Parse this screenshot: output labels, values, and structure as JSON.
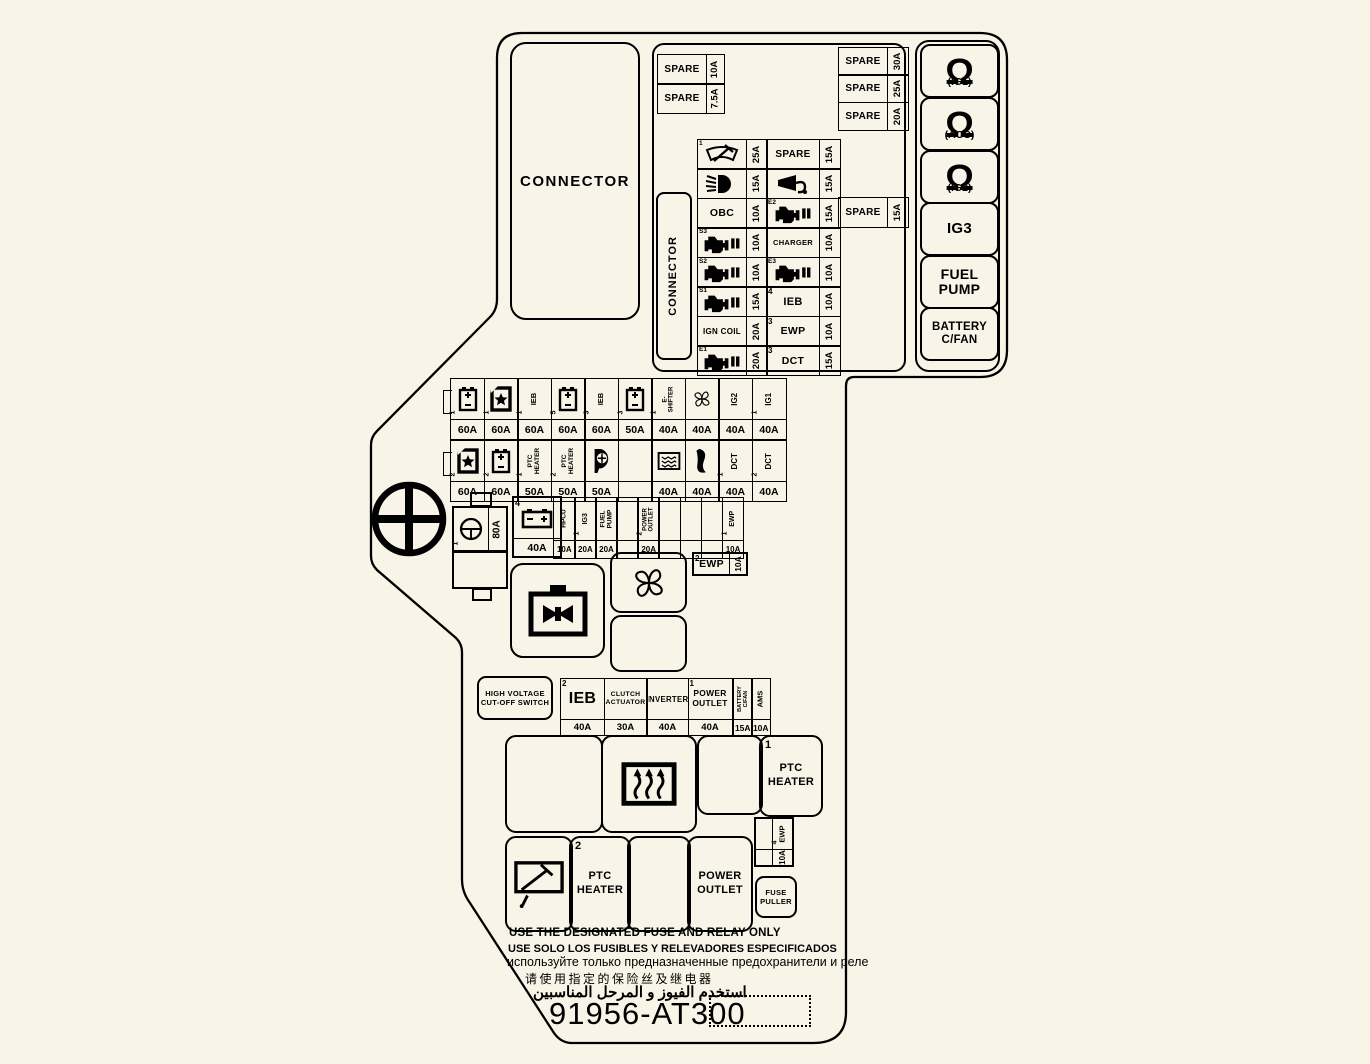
{
  "colors": {
    "background": "#f8f5e8",
    "ink": "#000000"
  },
  "connector_box": {
    "label": "CONNECTOR"
  },
  "connector_vertical": {
    "label": "CONNECTOR"
  },
  "spare_left": [
    {
      "label": "SPARE",
      "amp": "10A"
    },
    {
      "label": "SPARE",
      "amp": "7.5A"
    }
  ],
  "spare_right": [
    {
      "label": "SPARE",
      "amp": "30A"
    },
    {
      "label": "SPARE",
      "amp": "25A"
    },
    {
      "label": "SPARE",
      "amp": "20A"
    }
  ],
  "spare_mid": {
    "label": "SPARE",
    "amp": "15A"
  },
  "top_grid": [
    [
      {
        "icon": "wiper",
        "sup": "1"
      },
      {
        "amp": "25A"
      },
      {
        "label": "SPARE",
        "size": 10
      },
      {
        "amp": "15A"
      }
    ],
    [
      {
        "icon": "headlight"
      },
      {
        "amp": "15A"
      },
      {
        "icon": "horn"
      },
      {
        "amp": "15A"
      }
    ],
    [
      {
        "label": "OBC",
        "size": 10.5
      },
      {
        "amp": "10A"
      },
      {
        "icon": "engine",
        "sup": "E2"
      },
      {
        "amp": "15A"
      }
    ],
    [
      {
        "icon": "engine",
        "sup": "S3"
      },
      {
        "amp": "10A"
      },
      {
        "label": "CHARGER",
        "size": 7.5
      },
      {
        "amp": "10A"
      }
    ],
    [
      {
        "icon": "engine",
        "sup": "S2"
      },
      {
        "amp": "10A"
      },
      {
        "icon": "engine",
        "sup": "E3"
      },
      {
        "amp": "10A"
      }
    ],
    [
      {
        "icon": "engine",
        "sup": "S1"
      },
      {
        "amp": "15A"
      },
      {
        "label": "IEB",
        "sup": "4",
        "size": 11
      },
      {
        "amp": "10A"
      }
    ],
    [
      {
        "label": "IGN COIL",
        "size": 8
      },
      {
        "amp": "20A"
      },
      {
        "label": "EWP",
        "sup": "3",
        "size": 10.5
      },
      {
        "amp": "10A"
      }
    ],
    [
      {
        "icon": "engine",
        "sup": "E1"
      },
      {
        "amp": "20A"
      },
      {
        "label": "DCT",
        "sup": "3",
        "size": 10.5
      },
      {
        "amp": "15A"
      }
    ]
  ],
  "ig_column": [
    {
      "icon": "ignition",
      "label": "(IG1)"
    },
    {
      "icon": "ignition",
      "label": "(ACC)"
    },
    {
      "icon": "ignition",
      "label": "(IG2)"
    },
    {
      "lines": [
        "IG3"
      ],
      "size": 15
    },
    {
      "lines": [
        "FUEL",
        "PUMP"
      ],
      "size": 14
    },
    {
      "lines": [
        "BATTERY",
        "C/FAN"
      ],
      "size": 11.5
    }
  ],
  "mid_row1": [
    {
      "icon": "battery",
      "sup": "1",
      "amp": "60A"
    },
    {
      "icon": "battery-star",
      "sup": "1",
      "amp": "60A"
    },
    {
      "vlabel": [
        "IEB"
      ],
      "sup": "1",
      "amp": "60A",
      "size": 7.5
    },
    {
      "icon": "battery",
      "sup": "5",
      "amp": "60A"
    },
    {
      "vlabel": [
        "IEB"
      ],
      "sup": "3",
      "amp": "60A",
      "size": 7.5
    },
    {
      "icon": "battery",
      "sup": "3",
      "amp": "50A"
    },
    {
      "vlabel": [
        "E-",
        "SHIFTER"
      ],
      "sup": "1",
      "amp": "40A",
      "size": 6
    },
    {
      "icon": "fan",
      "amp": "40A"
    },
    {
      "vlabel": [
        "IG2"
      ],
      "amp": "40A",
      "size": 8
    },
    {
      "vlabel": [
        "IG1"
      ],
      "sup": "1",
      "amp": "40A",
      "size": 8
    }
  ],
  "mid_row2": [
    {
      "icon": "battery-star",
      "sup": "2",
      "amp": "60A"
    },
    {
      "icon": "battery",
      "sup": "2",
      "amp": "60A"
    },
    {
      "vlabel": [
        "PTC",
        "HEATER"
      ],
      "sup": "1",
      "amp": "50A",
      "size": 6.5
    },
    {
      "vlabel": [
        "PTC",
        "HEATER"
      ],
      "sup": "2",
      "amp": "50A",
      "size": 6.5
    },
    {
      "icon": "blower",
      "amp": "50A"
    },
    {},
    {
      "icon": "defrost",
      "amp": "40A"
    },
    {
      "icon": "heater-curve",
      "amp": "40A"
    },
    {
      "vlabel": [
        "DCT"
      ],
      "sup": "1",
      "amp": "40A",
      "size": 8
    },
    {
      "vlabel": [
        "DCT"
      ],
      "sup": "2",
      "amp": "40A",
      "size": 8
    }
  ],
  "mid_strip": [
    {
      "vlabel": [
        "HPCU"
      ],
      "amp": "10A",
      "size": 6.5
    },
    {
      "vlabel": [
        "IG3"
      ],
      "sup": "1",
      "amp": "20A",
      "size": 7
    },
    {
      "vlabel": [
        "FUEL",
        "PUMP"
      ],
      "amp": "20A",
      "size": 6.5
    },
    {},
    {
      "vlabel": [
        "POWER",
        "OUTLET"
      ],
      "sup": "2",
      "amp": "20A",
      "size": 6
    },
    {},
    {},
    {},
    {
      "vlabel": [
        "EWP"
      ],
      "sup": "1",
      "amp": "10A",
      "size": 7
    }
  ],
  "fusible_link": {
    "sup": "1",
    "icon": "steering",
    "amp": "80A"
  },
  "battery4": {
    "sup": "4",
    "icon": "battery-flat",
    "amp": "40A"
  },
  "ewp2": {
    "sup": "2",
    "label": "EWP",
    "amp": "10A"
  },
  "ewp4": {
    "sup": "4",
    "label": "EWP",
    "amp": "10A"
  },
  "hv_switch": {
    "line1": "HIGH VOLTAGE",
    "line2": "CUT-OFF SWITCH"
  },
  "bottom_strip": [
    {
      "label": "IEB",
      "sup": "2",
      "amp": "40A",
      "size": 16
    },
    {
      "lines": [
        "CLUTCH",
        "ACTUATOR"
      ],
      "amp": "30A",
      "size": 6.8
    },
    {
      "label": "INVERTER",
      "amp": "40A",
      "size": 7.8
    },
    {
      "lines": [
        "POWER",
        "OUTLET"
      ],
      "sup": "1",
      "amp": "40A",
      "size": 8.4
    }
  ],
  "side_pair": [
    {
      "vlabel": [
        "BATTERY",
        "C/FAN"
      ],
      "amp": "15A",
      "size": 5.6
    },
    {
      "vlabel": [
        "AMS"
      ],
      "amp": "10A",
      "size": 7.5
    }
  ],
  "big_row1": [
    {},
    {
      "icon": "ptc-heater"
    },
    {},
    {
      "sup": "1",
      "lines": [
        "PTC",
        "HEATER"
      ]
    }
  ],
  "big_row2": [
    {
      "icon": "rear-wiper"
    },
    {
      "sup": "2",
      "lines": [
        "PTC",
        "HEATER"
      ]
    },
    {},
    {
      "lines": [
        "POWER",
        "OUTLET"
      ]
    }
  ],
  "fuse_puller": {
    "line1": "FUSE",
    "line2": "PULLER"
  },
  "notices": [
    "USE THE DESIGNATED FUSE AND RELAY ONLY",
    "USE SOLO LOS FUSIBLES Y RELEVADORES ESPECIFICADOS",
    "используйте только предназначенные предохранители и реле",
    "请使用指定的保险丝及继电器",
    "استخدم الفيوز و المرحل المناسبين"
  ],
  "part_number": "91956-AT300"
}
